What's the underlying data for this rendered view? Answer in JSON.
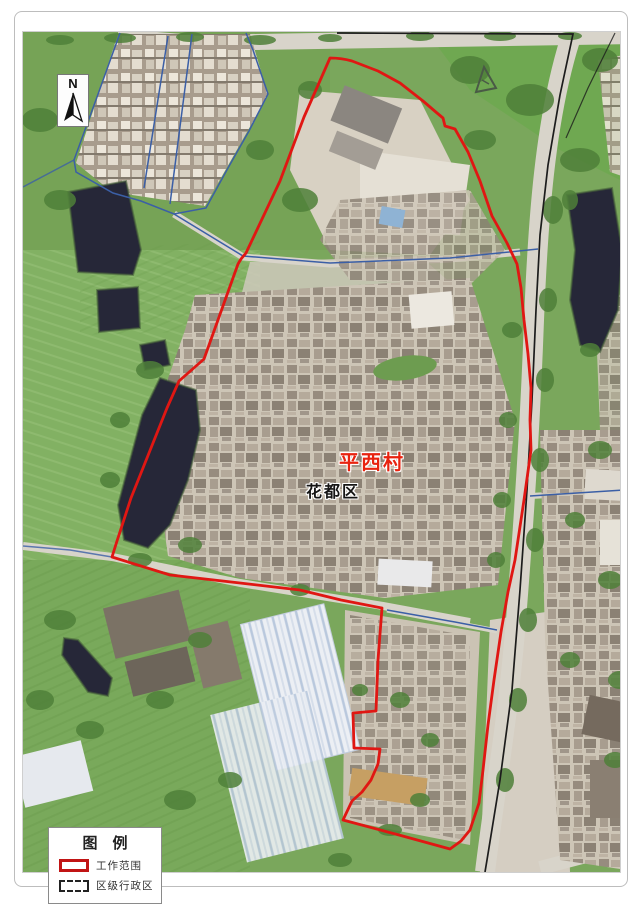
{
  "compass": {
    "letter": "N"
  },
  "map_labels": {
    "village": "平西村",
    "district": "花都区",
    "village_color": "#e8230f",
    "district_color": "#151515"
  },
  "legend": {
    "title": "图　例",
    "items": [
      {
        "label": "工作范围",
        "swatch": "red-rectangle",
        "color": "#c11414"
      },
      {
        "label": "区级行政区",
        "swatch": "black-dashed-rectangle",
        "color": "#222222"
      }
    ]
  },
  "colors": {
    "work_boundary": "#e01713",
    "admin_line": "#3b5fa6",
    "road_centerline": "#1c1c1c",
    "pond": "#262738",
    "field_green": "#7aa75c",
    "road_fill": "#d8d4ca"
  }
}
